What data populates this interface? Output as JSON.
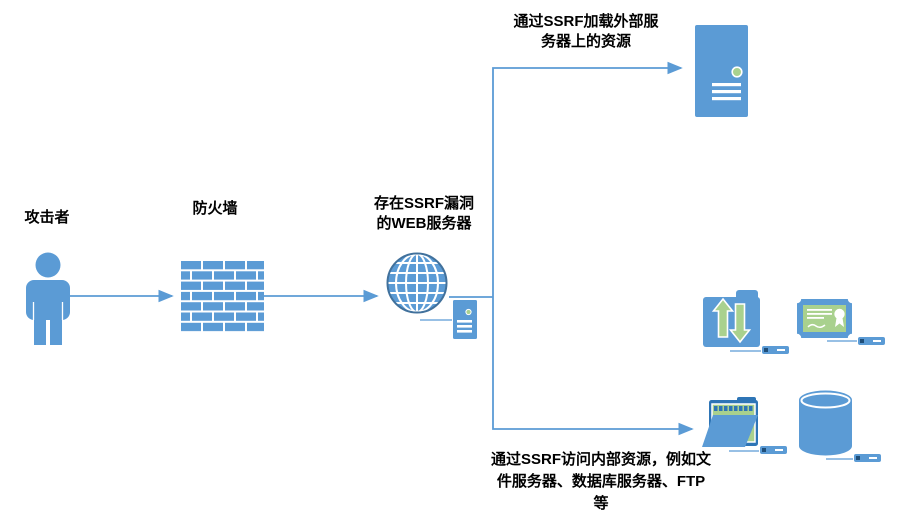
{
  "diagram": {
    "attacker": {
      "label": "攻击者"
    },
    "firewall": {
      "label": "防火墙"
    },
    "web_server": {
      "label_line1": "存在SSRF漏洞",
      "label_line2": "的WEB服务器"
    },
    "external_server": {
      "caption_line1": "通过SSRF加载外部服",
      "caption_line2": "务器上的资源"
    },
    "internal_resources": {
      "caption_line1": "通过SSRF访问内部资源，例如文",
      "caption_line2": "件服务器、数据库服务器、FTP",
      "caption_line3": "等"
    }
  },
  "colors": {
    "primary_blue": "#5B9BD5",
    "dark_blue": "#2E75B6",
    "globe_outline": "#41719C",
    "accent_green": "#A9D18E",
    "text": "#000000",
    "background": "#FFFFFF"
  },
  "icons": {
    "attacker": "person-icon",
    "firewall": "brick-wall-icon",
    "web_server": "globe-icon",
    "web_server_unit": "mini-server-icon",
    "external_server": "server-tower-icon",
    "ftp": "ftp-transfer-folder-icon",
    "certificate": "certificate-icon",
    "files": "open-folder-icon",
    "database": "database-cylinder-icon",
    "rack_unit": "rack-unit-icon"
  }
}
